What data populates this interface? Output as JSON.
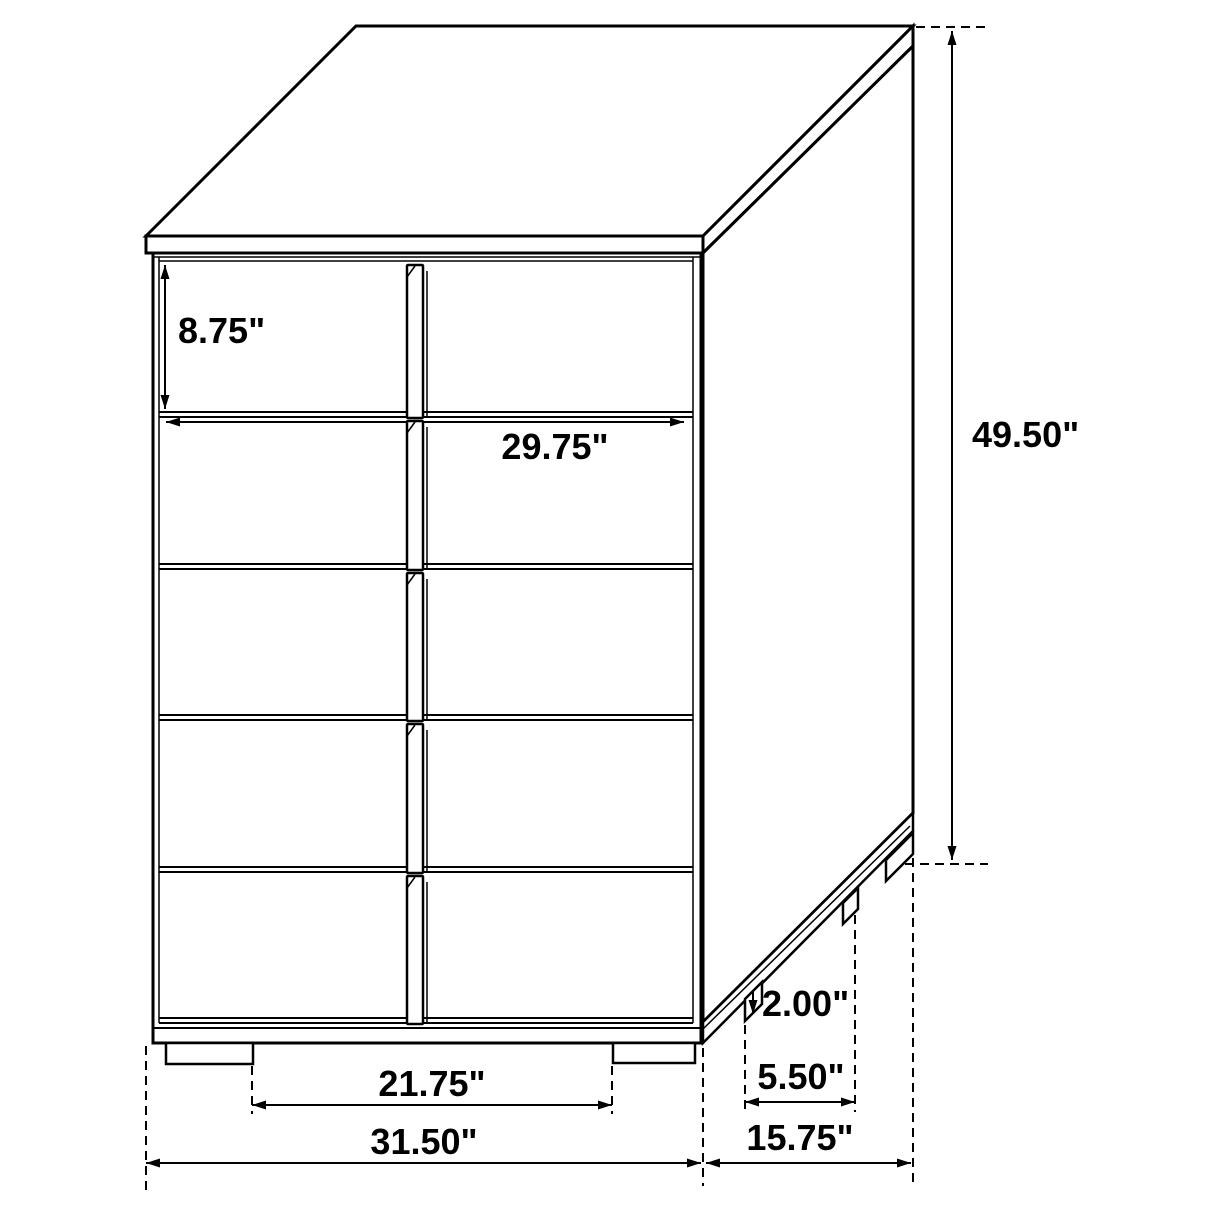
{
  "title": "Chest of drawers dimension drawing",
  "units": "inches",
  "colors": {
    "line": "#000000",
    "background": "#ffffff"
  },
  "furniture": {
    "type": "5-drawer chest",
    "drawer_rows": 5,
    "handle_style": "center vertical pulls"
  },
  "dimensions": {
    "drawer_height": "8.75\"",
    "interior_width": "29.75\"",
    "overall_height": "49.50\"",
    "foot_height": "2.00\"",
    "side_foot_spacing": "5.50\"",
    "front_foot_spacing": "21.75\"",
    "overall_width": "31.50\"",
    "overall_depth": "15.75\""
  }
}
